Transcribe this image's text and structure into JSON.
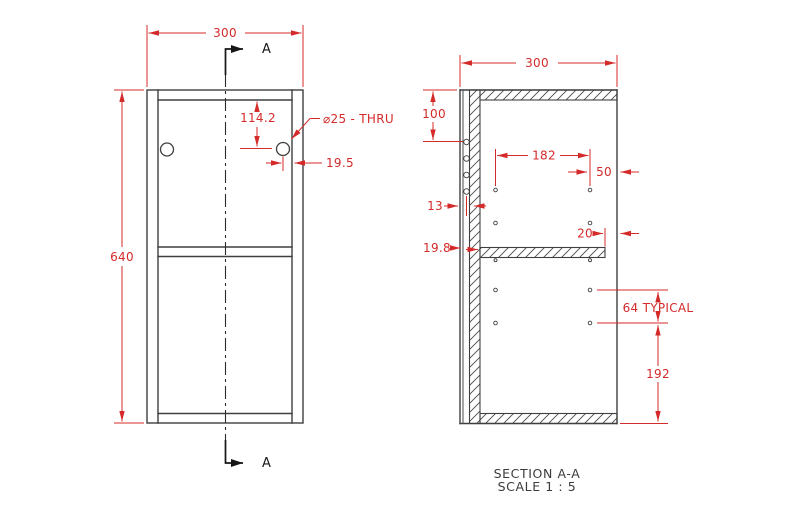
{
  "colors": {
    "dimension_red": "#d42a2a",
    "geometry_gray": "#3f3f3f",
    "section_black": "#161616",
    "background": "#ffffff"
  },
  "front_view": {
    "dim_width": "300",
    "dim_height": "640",
    "dim_hole_from_top": "114.2",
    "hole_callout": "⌀25 - THRU",
    "dim_hole_from_side": "19.5",
    "section_label_top": "A",
    "section_label_bottom": "A"
  },
  "section_view": {
    "dim_depth": "300",
    "dim_top_to_hole": "100",
    "dim_hole_span": "182",
    "dim_hole_to_front": "50",
    "dim_back_offset": "13",
    "dim_shelf_thickness": "19.8",
    "dim_shelf_setback": "20",
    "dim_hole_pitch": "64 TYPICAL",
    "dim_bottom_span": "192"
  },
  "caption": {
    "title": "SECTION A-A",
    "scale": "SCALE 1 : 5"
  }
}
